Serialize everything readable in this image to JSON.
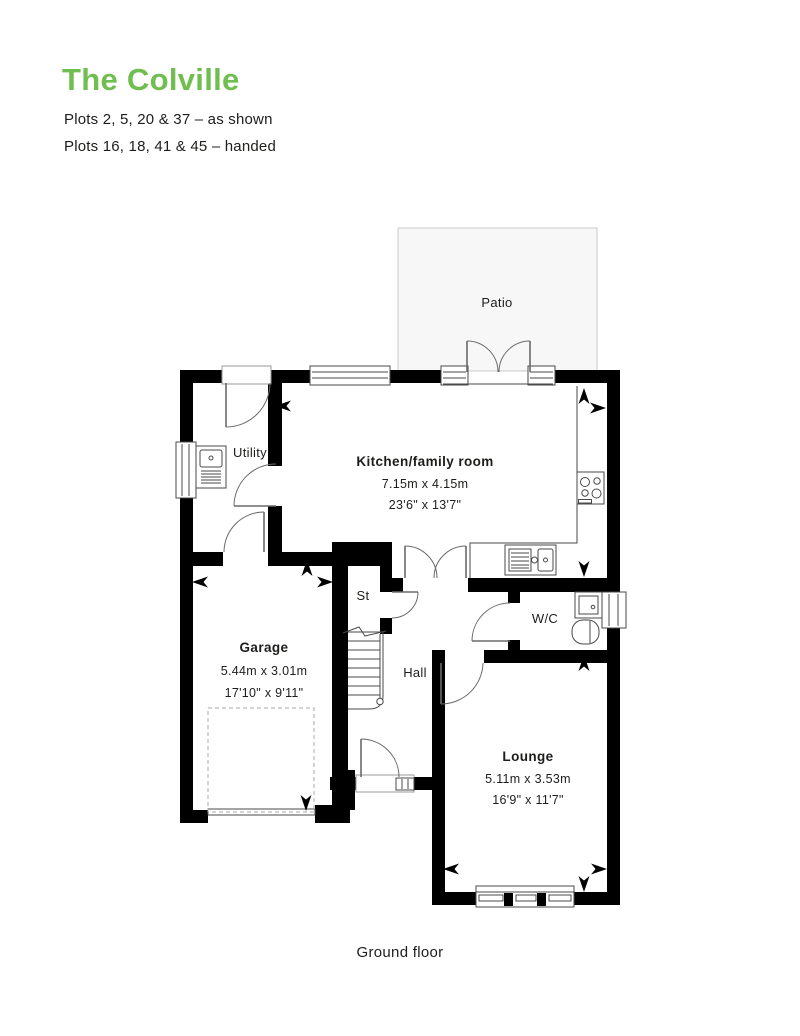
{
  "header": {
    "title": "The Colville",
    "title_color": "#6fbe4f",
    "plots_as_shown": "Plots 2, 5, 20 & 37 – as shown",
    "plots_handed": "Plots 16, 18, 41 & 45 – handed"
  },
  "plan": {
    "floor_label": "Ground floor",
    "patio_label": "Patio",
    "rooms": {
      "kitchen": {
        "name": "Kitchen/family room",
        "metric": "7.15m x 4.15m",
        "imperial": "23'6\" x 13'7\""
      },
      "utility": {
        "name": "Utility"
      },
      "store": {
        "name": "St"
      },
      "hall": {
        "name": "Hall"
      },
      "wc": {
        "name": "W/C"
      },
      "garage": {
        "name": "Garage",
        "metric": "5.44m x 3.01m",
        "imperial": "17'10\" x 9'11\""
      },
      "lounge": {
        "name": "Lounge",
        "metric": "5.11m x 3.53m",
        "imperial": "16'9\" x 11'7\""
      }
    },
    "colors": {
      "wall": "#000000",
      "line": "#4a4a4a",
      "patio_fill": "#f7f7f7",
      "patio_stroke": "#c9c9c9",
      "text": "#1d1d1b"
    }
  }
}
